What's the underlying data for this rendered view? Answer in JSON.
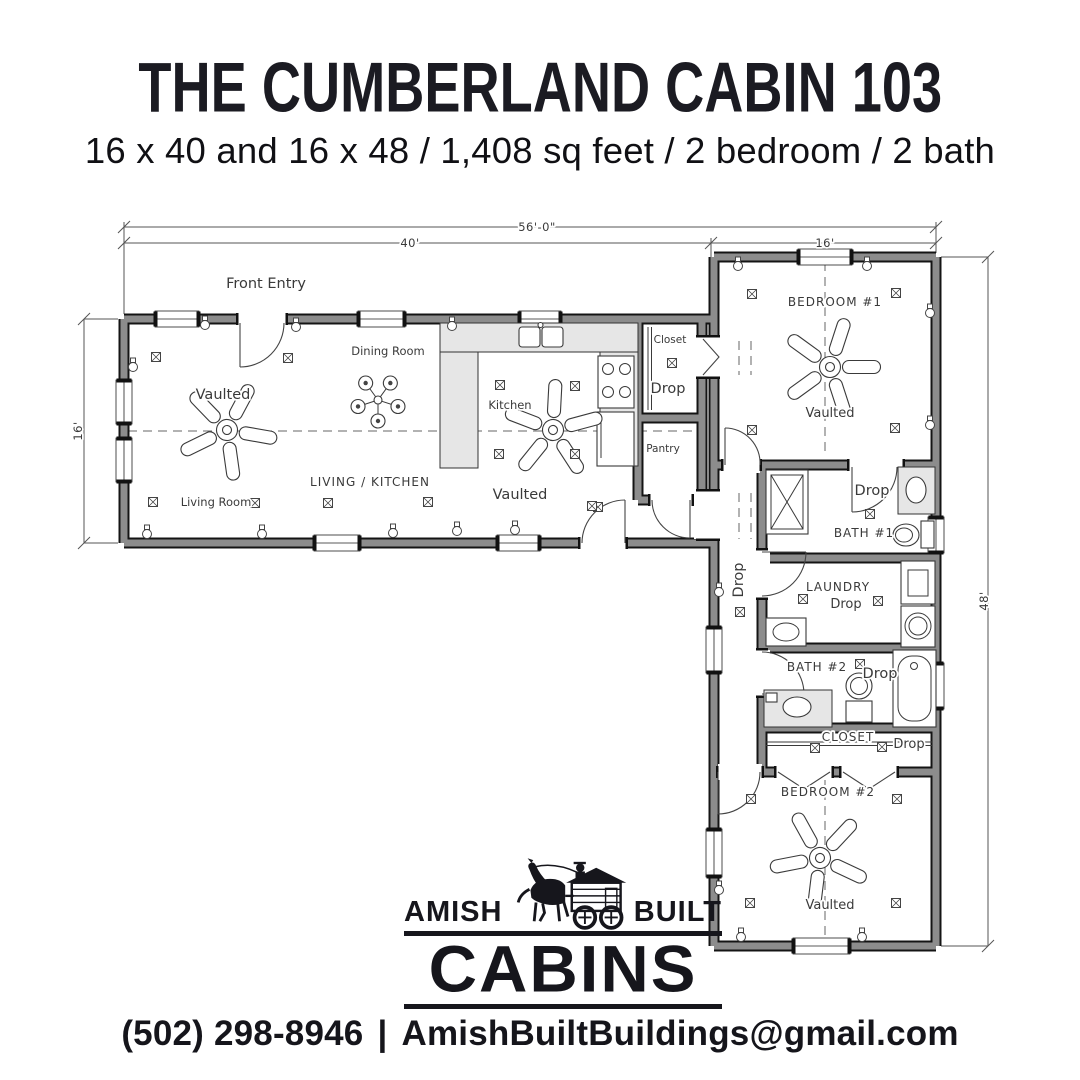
{
  "header": {
    "title": "THE CUMBERLAND CABIN 103",
    "subtitle": "16 x 40 and 16 x 48 / 1,408 sq feet / 2 bedroom / 2 bath"
  },
  "plan": {
    "dimensions": {
      "overall_width": "56'-0\"",
      "left_wing_width": "40'",
      "right_wing_width": "16'",
      "left_wing_depth": "16'",
      "right_wing_length": "48'"
    },
    "rooms": {
      "front_entry": "Front Entry",
      "dining_room": "Dining Room",
      "kitchen": "Kitchen",
      "living_kitchen": "LIVING / KITCHEN",
      "living_room": "Living Room",
      "vaulted_living": "Vaulted",
      "vaulted_kitchen": "Vaulted",
      "vaulted_bedroom1": "Vaulted",
      "vaulted_bedroom2": "Vaulted",
      "closet_kitchen": "Closet",
      "closet_kitchen_drop": "Drop",
      "pantry": "Pantry",
      "bedroom1": "BEDROOM #1",
      "bath1": "BATH #1",
      "bath1_drop": "Drop",
      "hall_drop": "Drop",
      "laundry": "LAUNDRY",
      "laundry_drop": "Drop",
      "bath2": "BATH #2",
      "bath2_drop": "Drop",
      "closet2": "CLOSET",
      "closet2_drop": "Drop",
      "bedroom2": "BEDROOM #2"
    }
  },
  "logo": {
    "amish": "AMISH",
    "built": "BUILT",
    "cabins": "CABINS"
  },
  "footer": {
    "phone": "(502) 298-8946",
    "separator": "|",
    "email": "AmishBuiltBuildings@gmail.com"
  },
  "colors": {
    "ink": "#16161c",
    "plan_line": "#3a3a3a",
    "wall_gray": "#8c8c8c",
    "background": "#ffffff"
  }
}
